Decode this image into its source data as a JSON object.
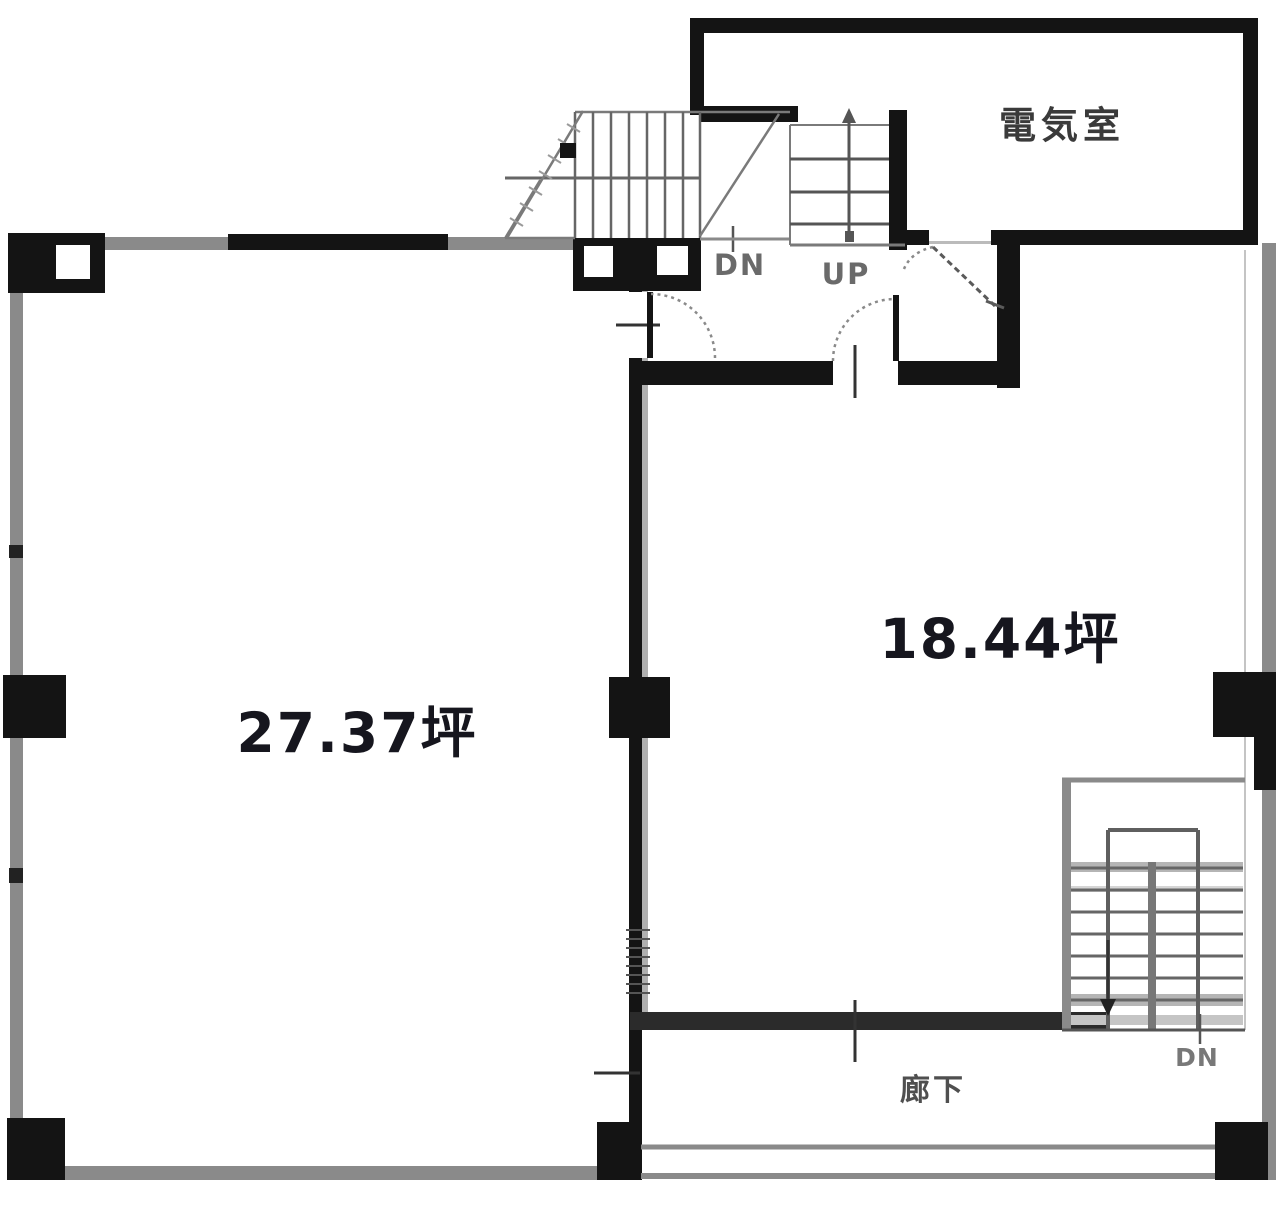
{
  "plan": {
    "title": "floor-plan",
    "rooms": {
      "left": {
        "area_label": "27.37坪"
      },
      "right": {
        "area_label": "18.44坪"
      },
      "electrical": {
        "name": "電気室"
      },
      "corridor": {
        "name": "廊下"
      }
    },
    "stairs": {
      "top_dn_label": "DN",
      "top_up_label": "UP",
      "bottom_dn_label": "DN"
    },
    "colors": {
      "background": "#ffffff",
      "wall_black": "#141414",
      "wall_gray": "#8a8a8a",
      "line_gray": "#6f6f6f",
      "shade_gray": "#b5b5b5",
      "text_dark": "#16161e",
      "text_gray": "#6a6a6a"
    }
  }
}
